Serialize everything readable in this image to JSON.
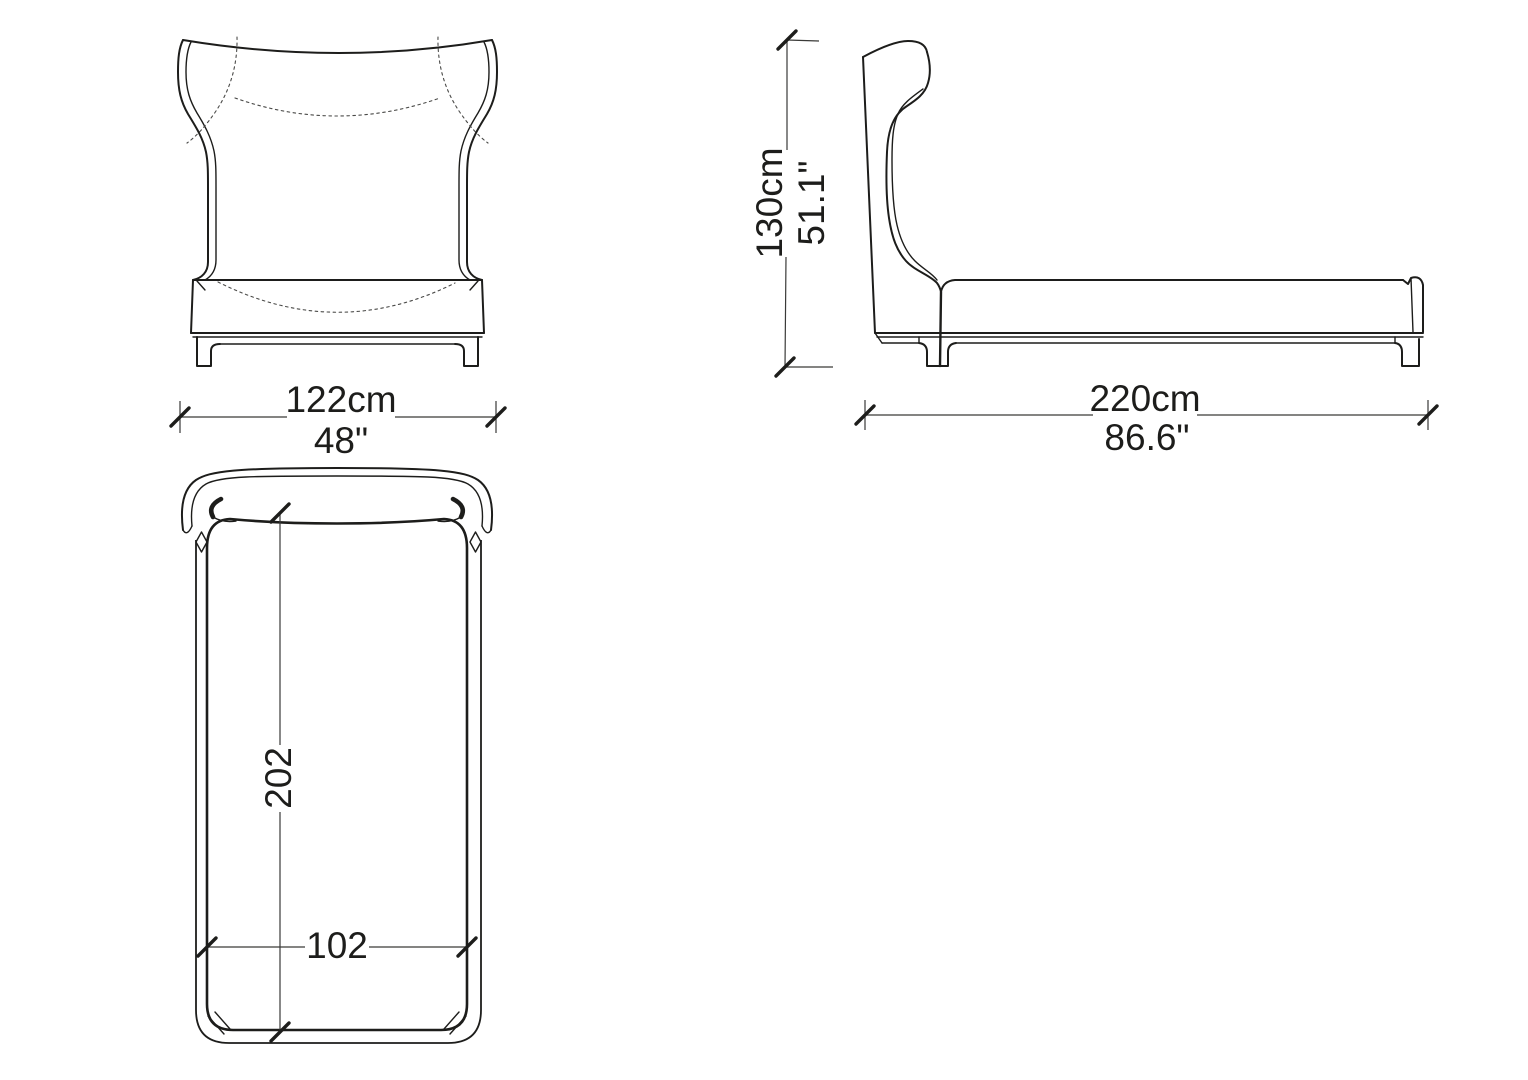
{
  "diagram": {
    "subject": "bed technical drawing",
    "line_color": "#1d1d1b",
    "background_color": "#ffffff"
  },
  "views": {
    "front": {
      "width_cm": "122cm",
      "width_in": "48\""
    },
    "side": {
      "height_cm": "130cm",
      "height_in": "51.1\"",
      "length_cm": "220cm",
      "length_in": "86.6\""
    },
    "plan": {
      "length": "202",
      "width": "102"
    }
  }
}
